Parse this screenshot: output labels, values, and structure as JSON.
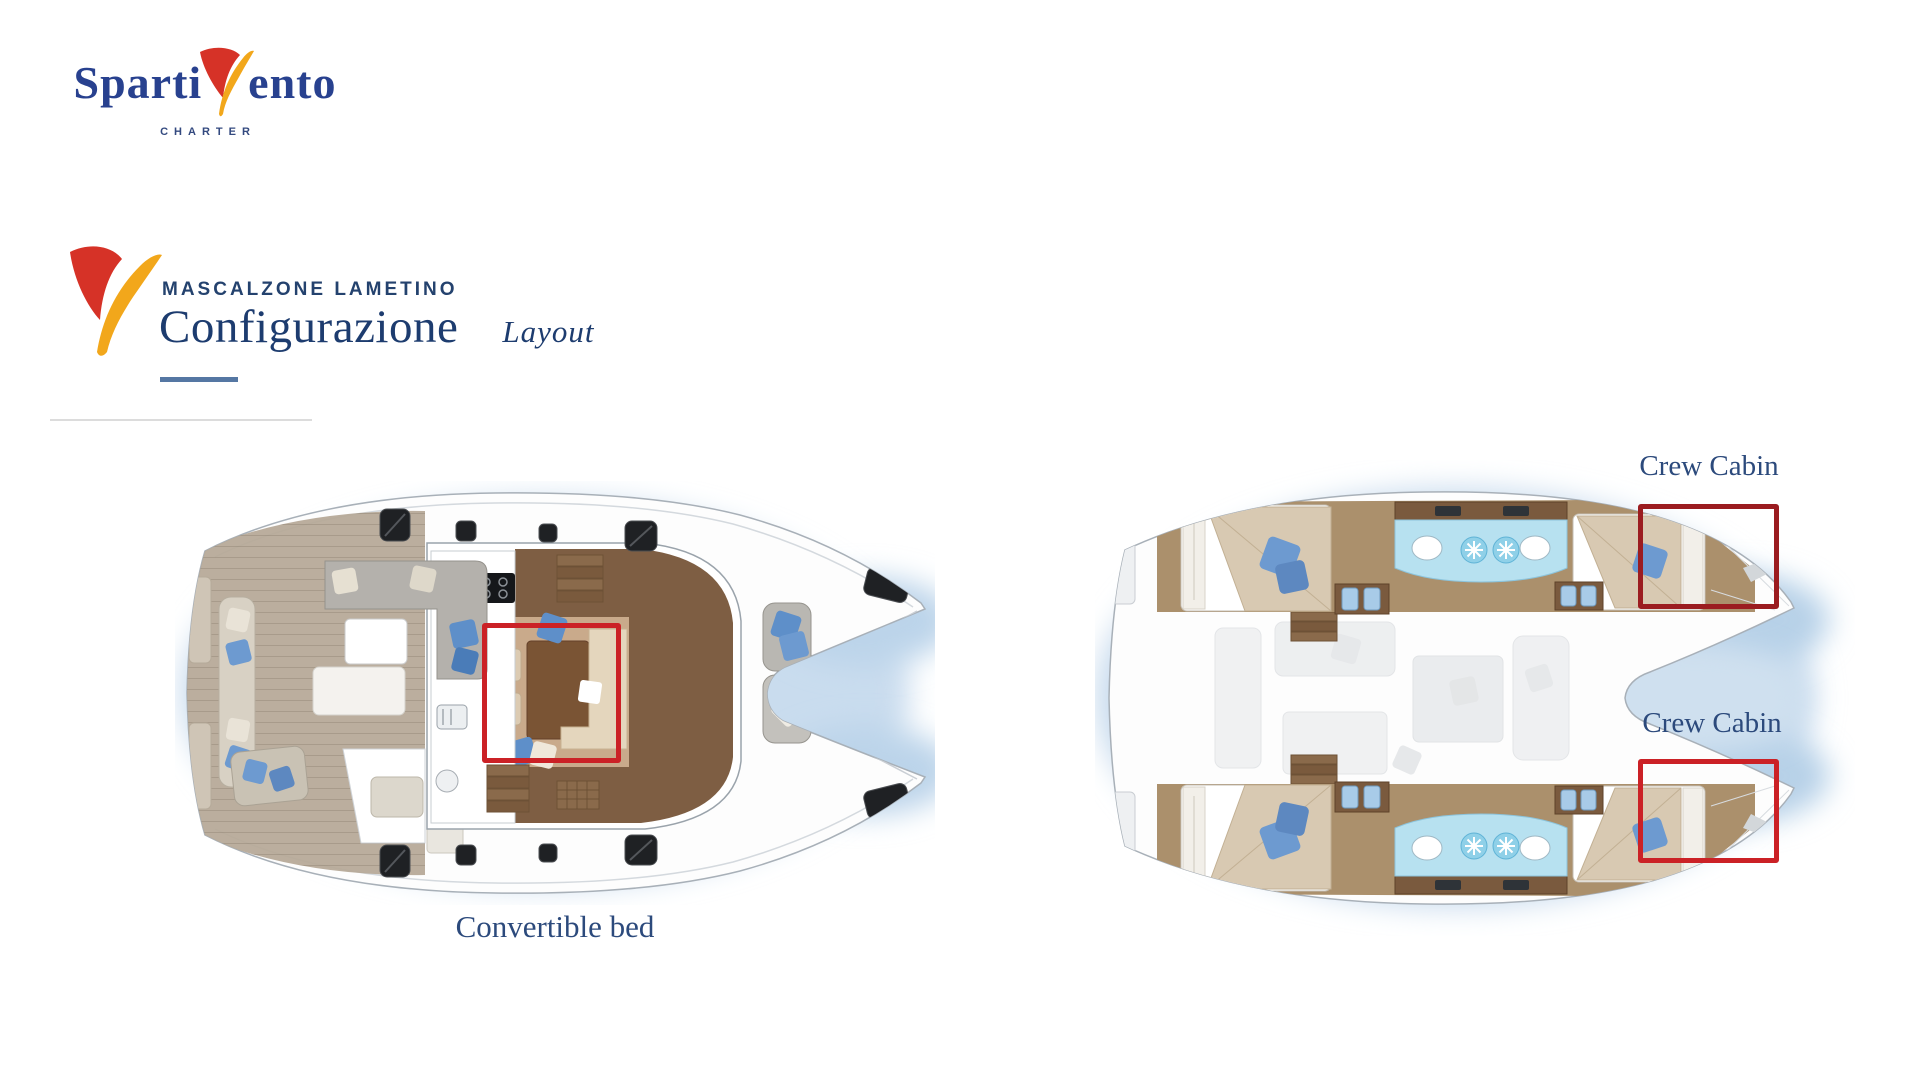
{
  "slide": {
    "background": "#ffffff"
  },
  "brand_logo": {
    "word_start": "Sparti",
    "word_end": "ento",
    "tagline": "CHARTER",
    "text_color": "#28418f",
    "tagline_color": "#33497f",
    "sail_red": "#d63227",
    "sail_yellow": "#f2a71b"
  },
  "section_header": {
    "eyebrow": "MASCALZONE LAMETINO",
    "title": "Configurazione",
    "subtitle": "Layout",
    "text_color": "#1d3c6f",
    "eyebrow_color": "#24426e",
    "underline_color": "#5577a3"
  },
  "plans": {
    "left_plan": {
      "annotation": {
        "label": "Convertible bed",
        "box_color": "#cb2126"
      }
    },
    "right_plan": {
      "annotation_top": {
        "label": "Crew Cabin",
        "box_color": "#9b1c20"
      },
      "annotation_bottom": {
        "label": "Crew Cabin",
        "box_color": "#cb2126"
      }
    },
    "label_color": "#2c4a7c"
  }
}
